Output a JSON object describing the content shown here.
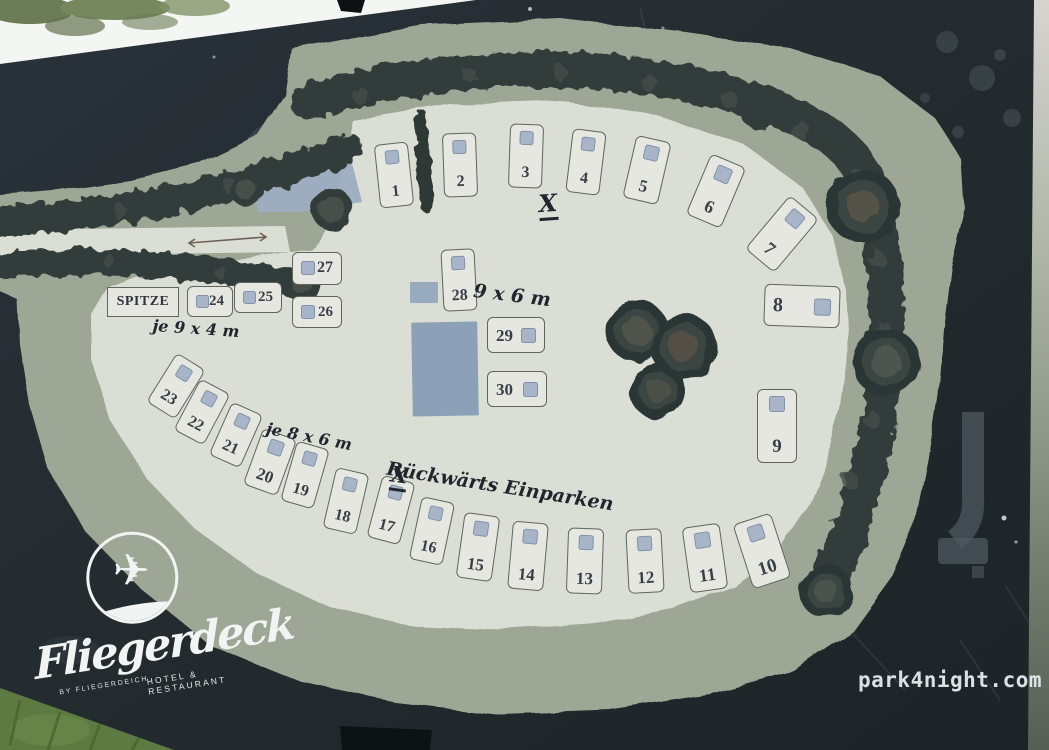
{
  "board": {
    "logo": {
      "brand": "Fliegerdeck",
      "sub_brand": "BY FLIEGERDEICH",
      "tagline": "HOTEL & RESTAURANT"
    },
    "watermark": "park4night.com"
  },
  "icons": {
    "airplane": "✈"
  },
  "map": {
    "area_label": "SPITZE",
    "annotations": [
      {
        "id": "x-top",
        "text": "X",
        "x": 548,
        "y": 206,
        "size": 24,
        "rot": -4,
        "underline": true
      },
      {
        "id": "dim-9x6",
        "text": "9 x 6 m",
        "x": 512,
        "y": 296,
        "size": 19,
        "rot": 7,
        "underline": false
      },
      {
        "id": "dim-9x4",
        "text": "je  9 x 4 m",
        "x": 196,
        "y": 329,
        "size": 16,
        "rot": 4,
        "underline": false
      },
      {
        "id": "dim-8x6",
        "text": "je  8 x 6 m",
        "x": 309,
        "y": 437,
        "size": 16,
        "rot": 11,
        "underline": false
      },
      {
        "id": "x-bottom",
        "text": "X",
        "x": 399,
        "y": 478,
        "size": 22,
        "rot": 8,
        "underline": true
      },
      {
        "id": "reverse-parking",
        "text": "Rückwärts Einparken",
        "x": 500,
        "y": 487,
        "size": 19,
        "rot": 9,
        "underline": false
      }
    ],
    "spots": [
      {
        "n": 1,
        "x": 394,
        "y": 175,
        "w": 34,
        "h": 64,
        "r": -6,
        "lay": "t"
      },
      {
        "n": 2,
        "x": 460,
        "y": 165,
        "w": 34,
        "h": 64,
        "r": -2,
        "lay": "t"
      },
      {
        "n": 3,
        "x": 526,
        "y": 156,
        "w": 34,
        "h": 64,
        "r": 2,
        "lay": "t"
      },
      {
        "n": 4,
        "x": 586,
        "y": 162,
        "w": 34,
        "h": 64,
        "r": 7,
        "lay": "t"
      },
      {
        "n": 5,
        "x": 647,
        "y": 170,
        "w": 36,
        "h": 64,
        "r": 13,
        "lay": "t"
      },
      {
        "n": 6,
        "x": 716,
        "y": 191,
        "w": 38,
        "h": 66,
        "r": 23,
        "lay": "t"
      },
      {
        "n": 7,
        "x": 782,
        "y": 234,
        "w": 38,
        "h": 70,
        "r": 40,
        "lay": "t"
      },
      {
        "n": 8,
        "x": 802,
        "y": 306,
        "w": 76,
        "h": 42,
        "r": 2,
        "lay": "r"
      },
      {
        "n": 9,
        "x": 777,
        "y": 426,
        "w": 40,
        "h": 74,
        "r": 0,
        "lay": "t"
      },
      {
        "n": 10,
        "x": 762,
        "y": 551,
        "w": 40,
        "h": 68,
        "r": -18,
        "lay": "t"
      },
      {
        "n": 11,
        "x": 705,
        "y": 558,
        "w": 38,
        "h": 66,
        "r": -8,
        "lay": "t"
      },
      {
        "n": 12,
        "x": 645,
        "y": 561,
        "w": 36,
        "h": 64,
        "r": -3,
        "lay": "t"
      },
      {
        "n": 13,
        "x": 585,
        "y": 561,
        "w": 36,
        "h": 66,
        "r": 2,
        "lay": "t"
      },
      {
        "n": 14,
        "x": 528,
        "y": 556,
        "w": 36,
        "h": 68,
        "r": 5,
        "lay": "t"
      },
      {
        "n": 15,
        "x": 478,
        "y": 547,
        "w": 36,
        "h": 66,
        "r": 8,
        "lay": "t"
      },
      {
        "n": 16,
        "x": 432,
        "y": 531,
        "w": 34,
        "h": 64,
        "r": 12,
        "lay": "t"
      },
      {
        "n": 17,
        "x": 391,
        "y": 510,
        "w": 34,
        "h": 64,
        "r": 15,
        "lay": "t"
      },
      {
        "n": 18,
        "x": 346,
        "y": 501,
        "w": 34,
        "h": 62,
        "r": 13,
        "lay": "t"
      },
      {
        "n": 19,
        "x": 305,
        "y": 475,
        "w": 34,
        "h": 62,
        "r": 16,
        "lay": "t"
      },
      {
        "n": 20,
        "x": 270,
        "y": 462,
        "w": 36,
        "h": 60,
        "r": 20,
        "lay": "t"
      },
      {
        "n": 21,
        "x": 236,
        "y": 435,
        "w": 34,
        "h": 58,
        "r": 24,
        "lay": "t"
      },
      {
        "n": 22,
        "x": 202,
        "y": 412,
        "w": 34,
        "h": 58,
        "r": 28,
        "lay": "t"
      },
      {
        "n": 23,
        "x": 176,
        "y": 386,
        "w": 34,
        "h": 58,
        "r": 32,
        "lay": "t"
      },
      {
        "n": 24,
        "x": 210,
        "y": 301,
        "w": 46,
        "h": 31,
        "r": 0,
        "lay": "l"
      },
      {
        "n": 25,
        "x": 258,
        "y": 297,
        "w": 48,
        "h": 31,
        "r": 0,
        "lay": "l"
      },
      {
        "n": 26,
        "x": 317,
        "y": 312,
        "w": 50,
        "h": 32,
        "r": 0,
        "lay": "l"
      },
      {
        "n": 27,
        "x": 317,
        "y": 268,
        "w": 50,
        "h": 33,
        "r": 0,
        "lay": "l"
      },
      {
        "n": 28,
        "x": 459,
        "y": 280,
        "w": 34,
        "h": 62,
        "r": -3,
        "lay": "t"
      },
      {
        "n": 29,
        "x": 516,
        "y": 335,
        "w": 58,
        "h": 36,
        "r": 0,
        "lay": "r"
      },
      {
        "n": 30,
        "x": 517,
        "y": 389,
        "w": 60,
        "h": 36,
        "r": 0,
        "lay": "r"
      }
    ],
    "colors": {
      "board": "#232b2f",
      "sage": "#9ea795",
      "inner": "#dbded5",
      "hedge": "#333e3b",
      "spotfill": "#e5e7e0",
      "spotborder": "#5d665c",
      "marker": "#a8b5c9",
      "markerborder": "#8492a9",
      "building": "#8ca1b8",
      "ink": "#20252e",
      "num": "#383f47",
      "logo": "#f2f4f3",
      "wm": "#e6ebee"
    }
  }
}
